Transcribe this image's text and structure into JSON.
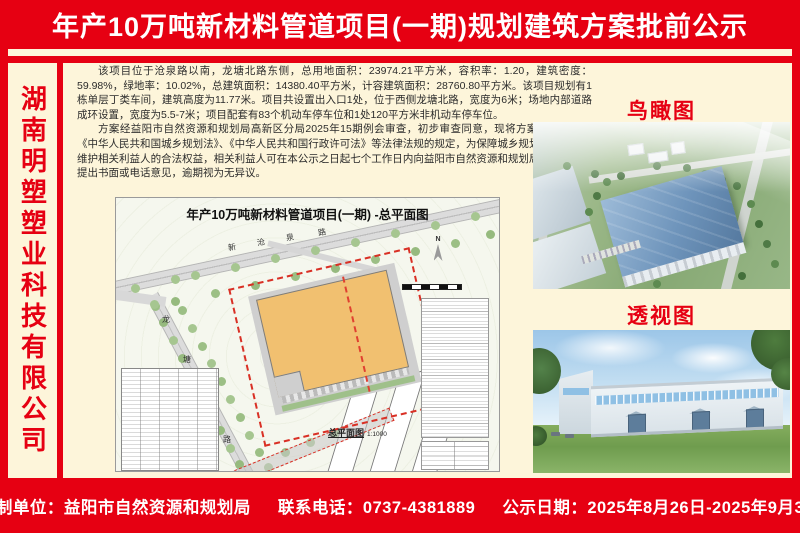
{
  "header": {
    "title": "年产10万吨新材料管道项目(一期)规划建筑方案批前公示"
  },
  "sidebar": {
    "company_name": "湖南明塑塑业科技有限公司"
  },
  "body": {
    "paragraphs": [
      "该项目位于沧泉路以南，龙塘北路东侧，总用地面积：23974.21平方米，容积率：1.20，建筑密度：59.98%，绿地率：10.02%，总建筑面积：14380.40平方米，计容建筑面积：28760.80平方米。该项目规划有1栋单层丁类车间，建筑高度为11.77米。项目共设置出入口1处，位于西侧龙塘北路，宽度为6米；场地内部道路成环设置，宽度为5.5-7米；项目配套有83个机动车停车位和1处120平方米非机动车停车位。",
      "方案经益阳市自然资源和规划局高新区分局2025年15期例会审查，初步审查同意，现将方案公示。根据《中华人民共和国城乡规划法》、《中华人民共和国行政许可法》等法律法规的规定，为保障城乡规划的合理性，维护相关利益人的合法权益，相关利益人可在本公示之日起七个工作日内向益阳市自然资源和规划局高新区分局提出书面或电话意见，逾期视为无异议。"
    ]
  },
  "site_plan": {
    "title": "年产10万吨新材料管道项目(一期) -总平面图",
    "road_top_chars": [
      "新",
      "沧",
      "泉",
      "路"
    ],
    "road_left_chars": [
      "龙",
      "塘",
      "北",
      "路"
    ],
    "drawing_label": "总平面图",
    "drawing_scale": "1:1000",
    "north_label": "N"
  },
  "renders": {
    "aerial_label": "鸟瞰图",
    "perspective_label": "透视图"
  },
  "footer": {
    "supervisor_label": "监制单位：益阳市自然资源和规划局",
    "phone_label": "联系电话：0737-4381889",
    "date_label": "公示日期：2025年8月26日-2025年9月3日"
  },
  "colors": {
    "banner_red": "#e60012",
    "cream_background": "#fdf5da",
    "building_orange": "#f1c070",
    "tree_green": "#a6c690",
    "roof_blue": "#6e94bb",
    "boundary_red": "#d93025"
  }
}
